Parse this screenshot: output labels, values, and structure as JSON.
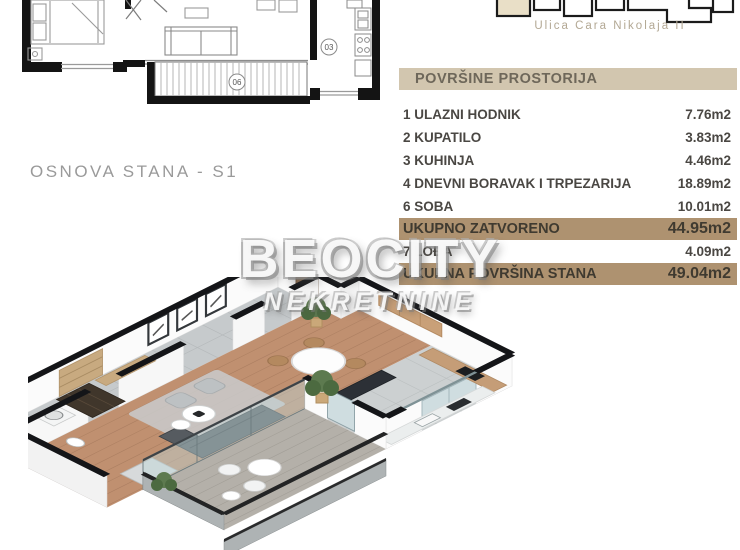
{
  "site": {
    "street_label": "Ulica Cara Nikolaja II",
    "highlight_unit_color": "#e9dfc7"
  },
  "plan_2d": {
    "caption": "OSNOVA STANA - S1",
    "room_labels": {
      "kitchen": "03",
      "loggia": "06"
    }
  },
  "watermark": {
    "brand": "BEOCITY",
    "subtitle": "NEKRETNINE"
  },
  "areas_table": {
    "title": "POVRŠINE PROSTORIJA",
    "rows": [
      {
        "label": "1 ULAZNI HODNIK",
        "value": "7.76m2",
        "highlight": false
      },
      {
        "label": "2 KUPATILO",
        "value": "3.83m2",
        "highlight": false
      },
      {
        "label": "3 KUHINJA",
        "value": "4.46m2",
        "highlight": false
      },
      {
        "label": "4 DNEVNI BORAVAK I TRPEZARIJA",
        "value": "18.89m2",
        "highlight": false
      },
      {
        "label": "6 SOBA",
        "value": "10.01m2",
        "highlight": false
      },
      {
        "label": "UKUPNO ZATVORENO",
        "value": "44.95m2",
        "highlight": true
      },
      {
        "label": "7 LOĐA",
        "value": "4.09m2",
        "highlight": false
      },
      {
        "label": "UKUPNA POVRŠINA STANA",
        "value": "49.04m2",
        "highlight": true
      }
    ],
    "colors": {
      "header_bg": "#d2c6af",
      "highlight_bg": "#ae9270",
      "text": "#4a4743"
    }
  }
}
